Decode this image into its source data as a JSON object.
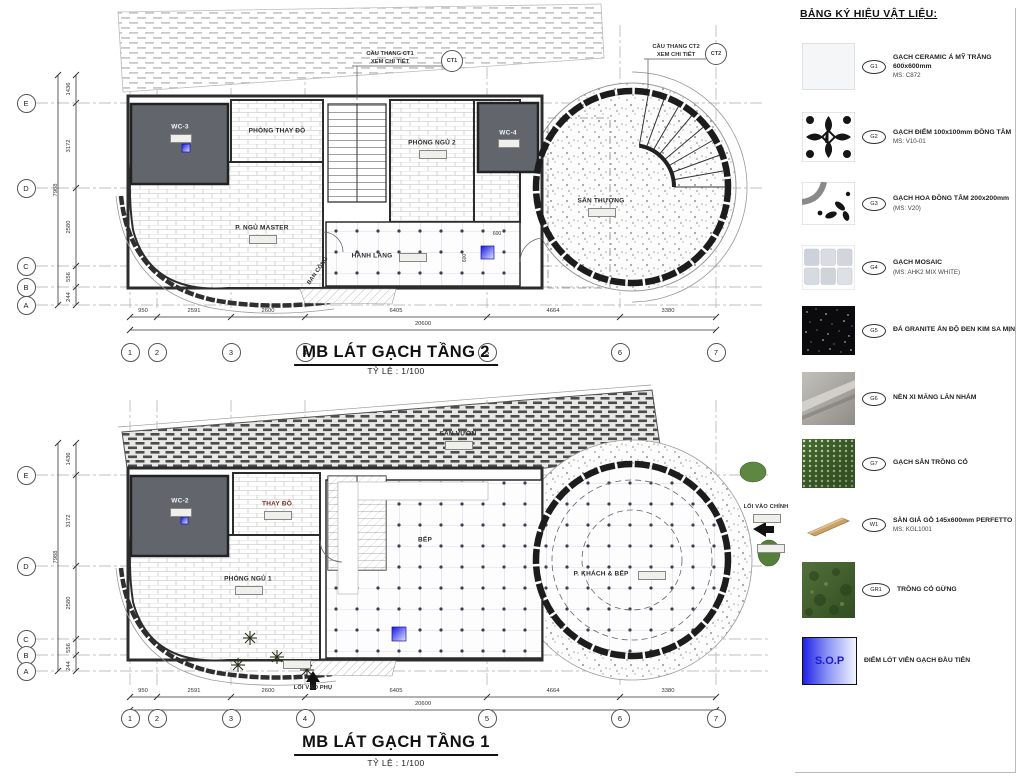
{
  "legend": {
    "title": "BẢNG KÝ HIỆU VẬT LIỆU:",
    "items": [
      {
        "tag": "G1",
        "label": "GẠCH CERAMIC Á MỸ TRẮNG 600x600mm",
        "sub": "MS: C872"
      },
      {
        "tag": "G2",
        "label": "GẠCH ĐIỂM 100x100mm ĐỒNG TÂM",
        "sub": "MS: V10-01"
      },
      {
        "tag": "G3",
        "label": "GẠCH HOA ĐỒNG TÂM 200x200mm",
        "sub": "(MS: V20)"
      },
      {
        "tag": "G4",
        "label": "GẠCH MOSAIC",
        "sub": "(MS: AHK2 MIX WHITE)"
      },
      {
        "tag": "G5",
        "label": "ĐÁ GRANITE ẤN ĐỘ ĐEN KIM SA MỊN",
        "sub": ""
      },
      {
        "tag": "G6",
        "label": "NỀN XI MĂNG LĂN NHÁM",
        "sub": ""
      },
      {
        "tag": "G7",
        "label": "GẠCH SÂN TRỒNG CỎ",
        "sub": ""
      },
      {
        "tag": "W1",
        "label": "SÀN GIẢ GỖ 145x600mm PERFETTO",
        "sub": "MS: KGL1001"
      },
      {
        "tag": "GR1",
        "label": "TRỒNG CỎ GỪNG",
        "sub": ""
      },
      {
        "tag": "",
        "label": "ĐIỂM LÓT VIÊN GẠCH ĐẦU TIÊN",
        "sub": "",
        "swatch_text": "S.O.P"
      }
    ]
  },
  "plan2": {
    "title": "MB LÁT GẠCH TẦNG 2",
    "scale": "TỶ LỆ : 1/100",
    "rooms": {
      "wc3": "WC-3",
      "thay_do": "PHÒNG THAY ĐỒ",
      "master": "P. NGỦ MASTER",
      "ngu2": "PHÒNG NGỦ 2",
      "wc4": "WC-4",
      "hanh_lang": "HÀNH LANG",
      "ban_cong": "BAN CÔNG",
      "san_thuong": "SÂN THƯỢNG"
    },
    "notes": {
      "ct1": "CẦU THANG CT1",
      "ct1_sub": "XEM CHI TIẾT",
      "ct1_tag": "CT1",
      "ct2": "CẦU THANG CT2",
      "ct2_sub": "XEM CHI TIẾT",
      "ct2_tag": "CT2",
      "dim600": "600"
    }
  },
  "plan1": {
    "title": "MB LÁT GẠCH TẦNG 1",
    "scale": "TỶ LỆ : 1/100",
    "rooms": {
      "wc2": "WC-2",
      "thay_do": "THAY ĐỒ",
      "ngu1": "PHÒNG NGỦ 1",
      "bep": "BẾP",
      "khach": "P. KHÁCH & BẾP",
      "san_vuon": "SÂN VƯỜN",
      "loi_chinh": "LỐI VÀO CHÍNH",
      "loi_phu": "LỐI VÀO PHỤ"
    }
  },
  "dims": {
    "h": [
      "950",
      "2591",
      "2600",
      "6405",
      "4664",
      "3380"
    ],
    "h_total": "20600",
    "v": [
      "1436",
      "3172",
      "2580",
      "556",
      "244"
    ],
    "v_total": "7988",
    "cols": [
      "1",
      "2",
      "3",
      "4",
      "5",
      "6",
      "7"
    ],
    "rows": [
      "E",
      "D",
      "C",
      "B",
      "A"
    ]
  }
}
